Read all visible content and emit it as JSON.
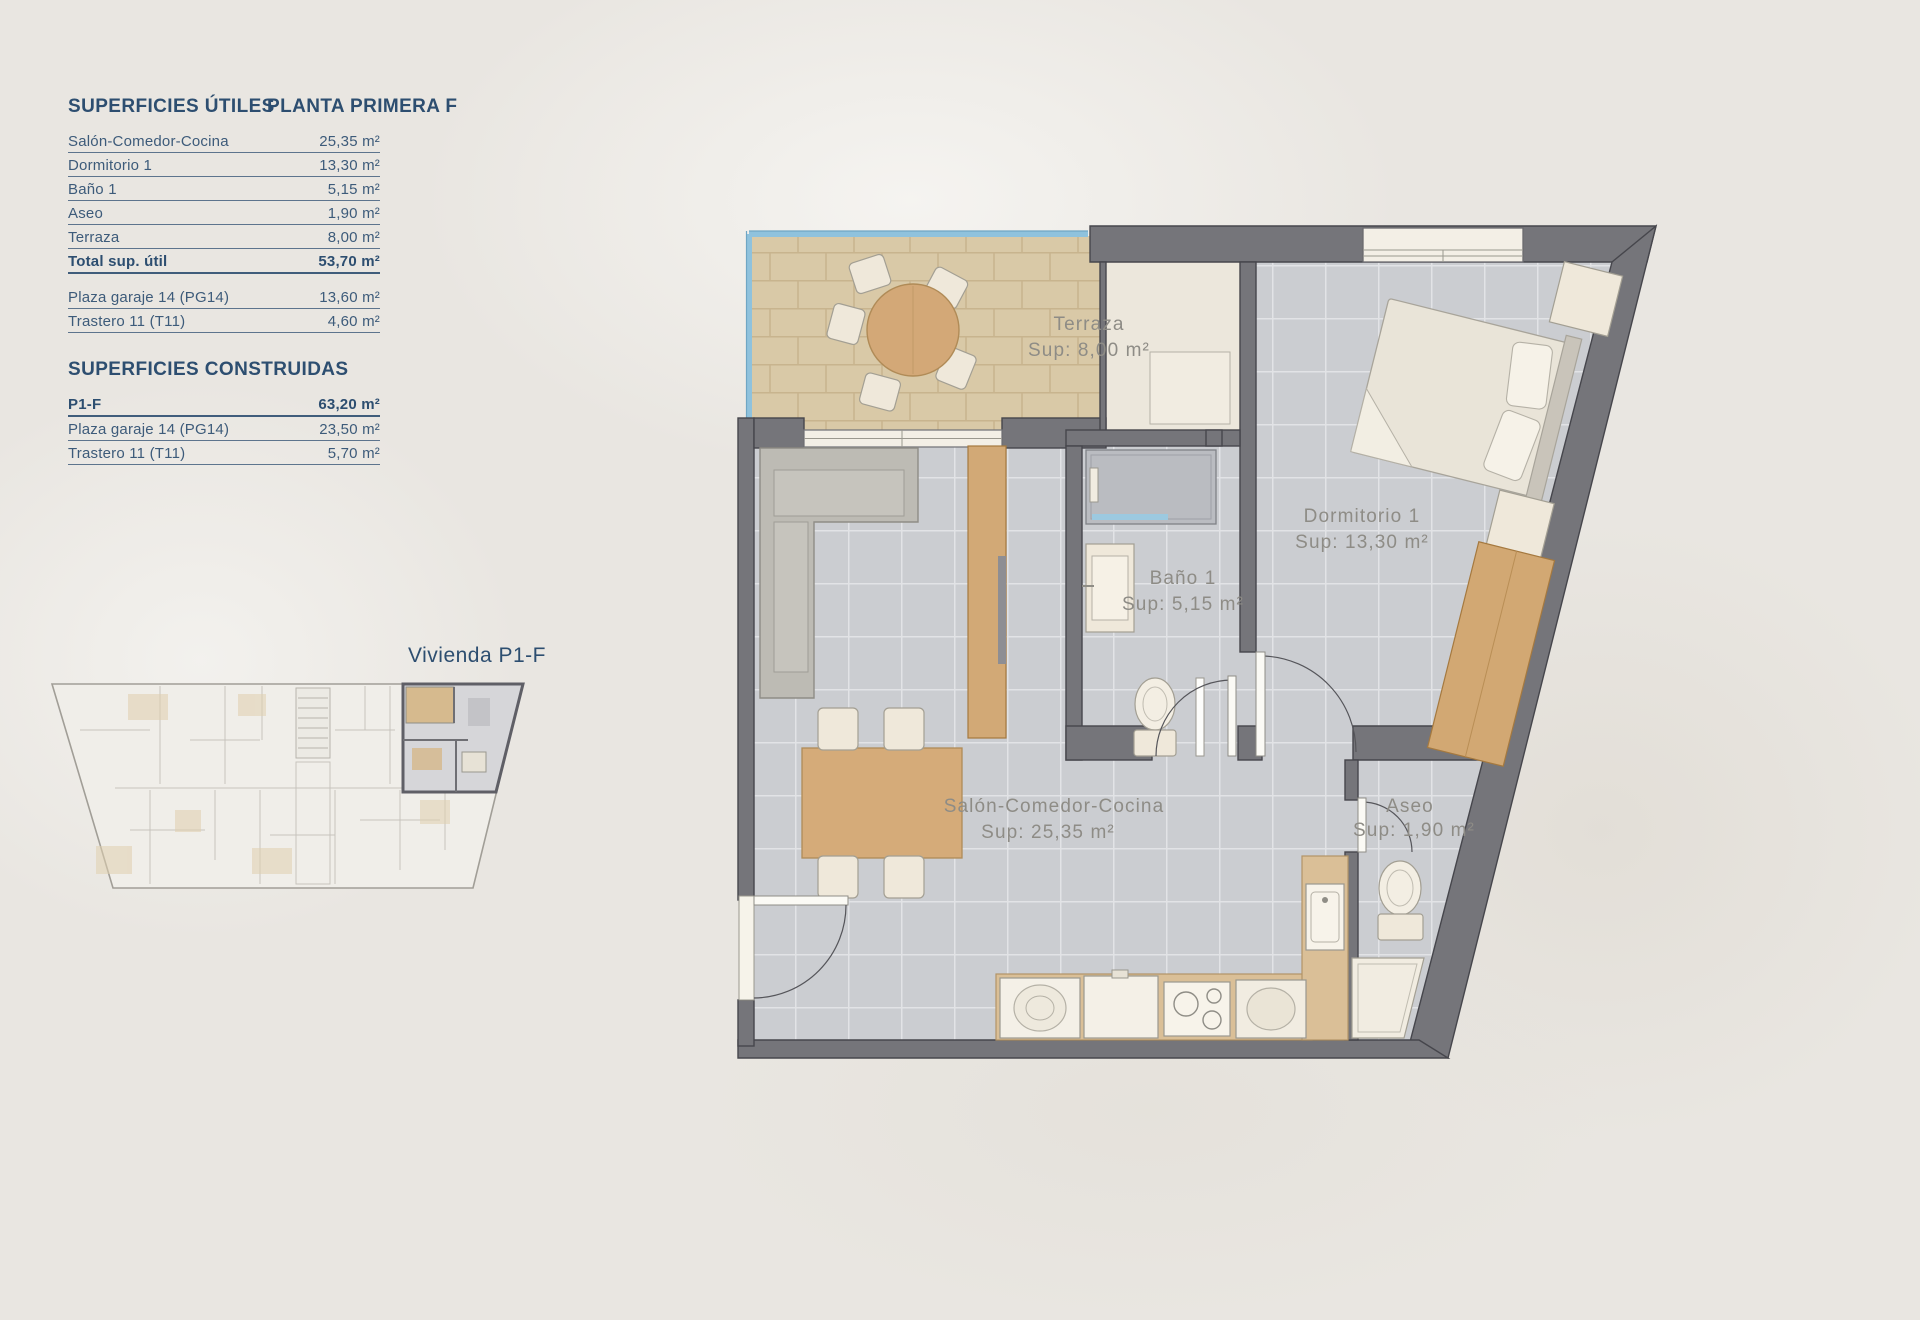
{
  "tables": {
    "utiles": {
      "title": "SUPERFICIES ÚTILES",
      "floor": "PLANTA PRIMERA F",
      "rows": [
        {
          "label": "Salón-Comedor-Cocina",
          "value": "25,35 m²"
        },
        {
          "label": "Dormitorio 1",
          "value": "13,30 m²"
        },
        {
          "label": "Baño 1",
          "value": "5,15 m²"
        },
        {
          "label": "Aseo",
          "value": "1,90 m²"
        },
        {
          "label": "Terraza",
          "value": "8,00 m²"
        }
      ],
      "total": {
        "label": "Total sup. útil",
        "value": "53,70 m²"
      },
      "annex": [
        {
          "label": "Plaza garaje 14 (PG14)",
          "value": "13,60 m²"
        },
        {
          "label": "Trastero 11 (T11)",
          "value": "4,60 m²"
        }
      ]
    },
    "construidas": {
      "title": "SUPERFICIES CONSTRUIDAS",
      "rows": [
        {
          "label": "P1-F",
          "value": "63,20 m²"
        },
        {
          "label": "Plaza garaje 14 (PG14)",
          "value": "23,50 m²"
        },
        {
          "label": "Trastero 11 (T11)",
          "value": "5,70 m²"
        }
      ]
    }
  },
  "miniplan": {
    "caption": "Vivienda P1-F"
  },
  "floorplan": {
    "rooms": [
      {
        "name": "Terraza",
        "sup": "Sup: 8,00 m²"
      },
      {
        "name": "Dormitorio 1",
        "sup": "Sup: 13,30 m²"
      },
      {
        "name": "Baño 1",
        "sup": "Sup: 5,15 m²"
      },
      {
        "name": "Salón-Comedor-Cocina",
        "sup": "Sup: 25,35 m²"
      },
      {
        "name": "Aseo",
        "sup": "Sup: 1,90 m²"
      }
    ]
  },
  "colors": {
    "accent_navy": "#2d4e70",
    "wall_gray": "#75757a",
    "tile_gray": "#cbcdd1",
    "terrace_tan": "#d9c9a7",
    "wood": "#d5ab79",
    "glass_blue": "#8fc2dd",
    "label_gray": "#8e8c86"
  }
}
